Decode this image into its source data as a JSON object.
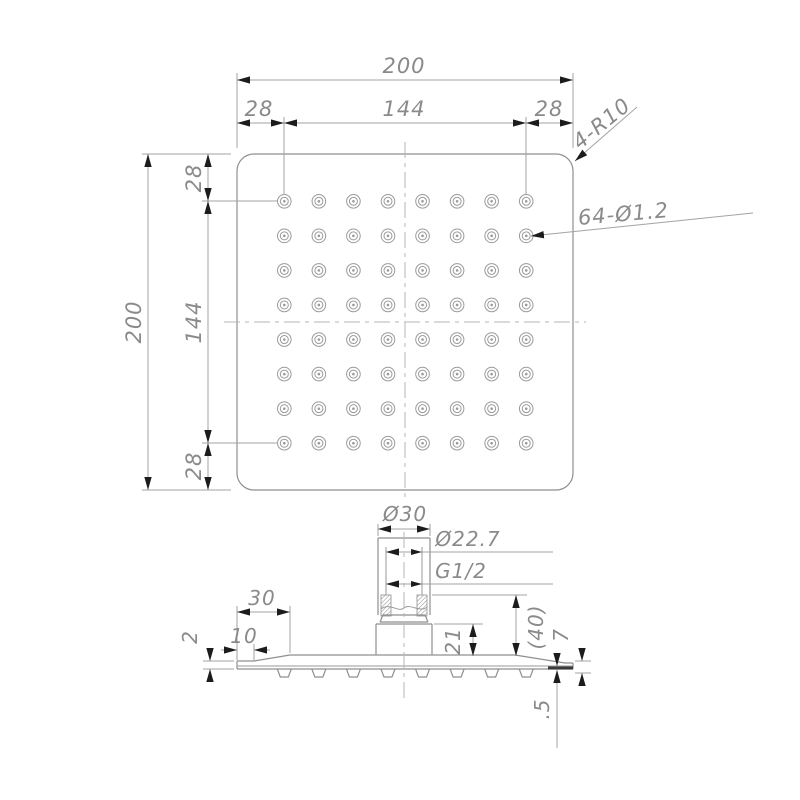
{
  "drawing": {
    "type": "technical-drawing",
    "subject": "square-shower-head",
    "colors": {
      "background": "#ffffff",
      "object_line": "#8f8f8f",
      "dimension_line": "#a3a3a3",
      "arrowhead": "#1c1c1c",
      "text": "#8a8a8a"
    },
    "top_view": {
      "overall_width_label": "200",
      "overall_height_label": "200",
      "h_segments": [
        "28",
        "144",
        "28"
      ],
      "v_segments": [
        "28",
        "144",
        "28"
      ],
      "corner_radius_label": "4-R10",
      "holes_label": "64-Ø1.2",
      "hole_grid": {
        "rows": 8,
        "cols": 8
      }
    },
    "side_view": {
      "pipe_outer_diameter_label": "Ø30",
      "thread_diameter_label": "Ø22.7",
      "thread_spec_label": "G1/2",
      "taper_width_label": "30",
      "edge_flat_label": "10",
      "edge_thickness_label": "2",
      "block_height_label": "21",
      "pipe_length_label": "(40)",
      "rim_height_label": "7",
      "lip_label": ".5"
    }
  }
}
